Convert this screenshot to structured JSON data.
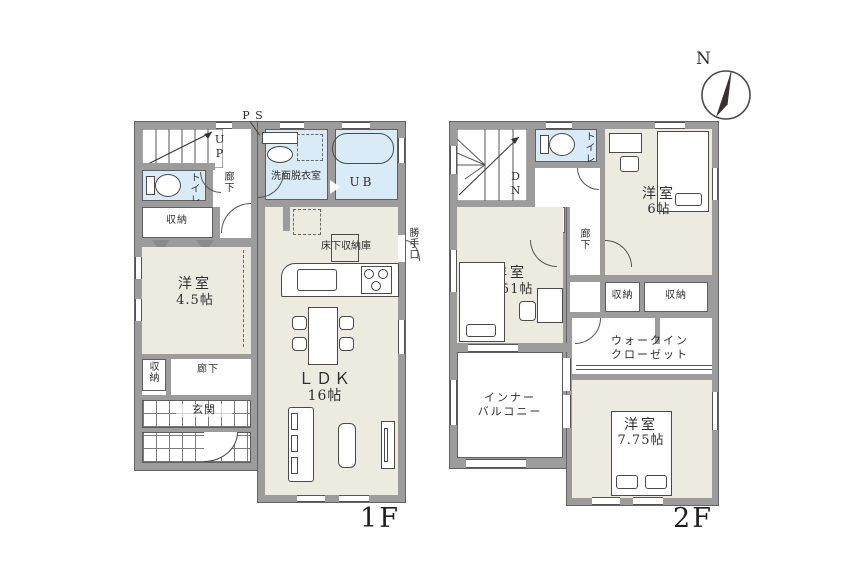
{
  "compass": {
    "north": "N"
  },
  "f1": {
    "floor": "1F",
    "ps": "P S",
    "up": "UP",
    "toilet": "トイレ",
    "hall_upper": "廊下",
    "washroom": "洗面脱衣室",
    "bath": "UB",
    "storage_upper": "収納",
    "room45_name": "洋室",
    "room45_size": "4.5帖",
    "underfloor_storage": "床下収納庫",
    "back_door": "勝手口",
    "storage_lower": "収納",
    "hall_lower": "廊下",
    "entrance": "玄関",
    "ldk_name": "ＬＤＫ",
    "ldk_size": "16帖"
  },
  "f2": {
    "floor": "2F",
    "dn": "DN",
    "toilet": "トイレ",
    "storage_stairs": "収納",
    "room6_name": "洋室",
    "room6_size": "6帖",
    "hall": "廊下",
    "room551_name": "洋室",
    "room551_size": "5.51帖",
    "storage_a": "収納",
    "storage_b": "収納",
    "wic_line1": "ウォークイン",
    "wic_line2": "クローゼット",
    "balcony_line1": "インナー",
    "balcony_line2": "バルコニー",
    "room775_name": "洋室",
    "room775_size": "7.75帖"
  }
}
